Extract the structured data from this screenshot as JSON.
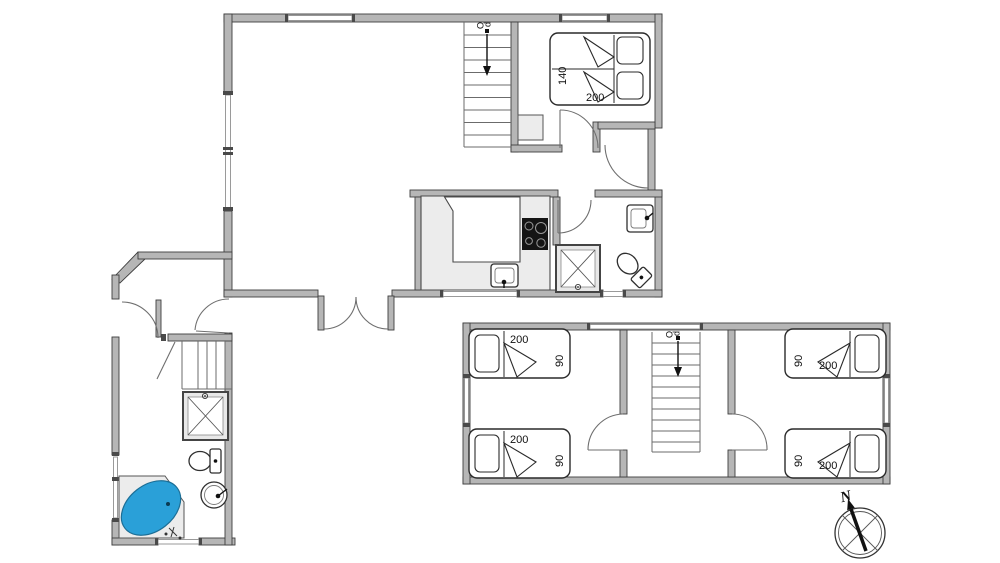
{
  "ground_floor": {
    "stairs": {
      "label": "Op"
    },
    "double_bed": {
      "width_cm": "140",
      "length_cm": "200"
    }
  },
  "first_floor": {
    "stairs": {
      "label": "Op"
    },
    "beds": [
      {
        "position": "left-top",
        "length_cm": "200",
        "width_cm": "90"
      },
      {
        "position": "left-bottom",
        "length_cm": "200",
        "width_cm": "90"
      },
      {
        "position": "right-top",
        "length_cm": "200",
        "width_cm": "90"
      },
      {
        "position": "right-bottom",
        "length_cm": "200",
        "width_cm": "90"
      }
    ]
  },
  "compass": {
    "north_label": "N"
  },
  "colors": {
    "wall_fill": "#b6b6b6",
    "wall_edge": "#3d3d3d",
    "fixture_gray": "#ececec",
    "stove_black": "#141414",
    "tub_water_blue": "#2aa0d8"
  }
}
